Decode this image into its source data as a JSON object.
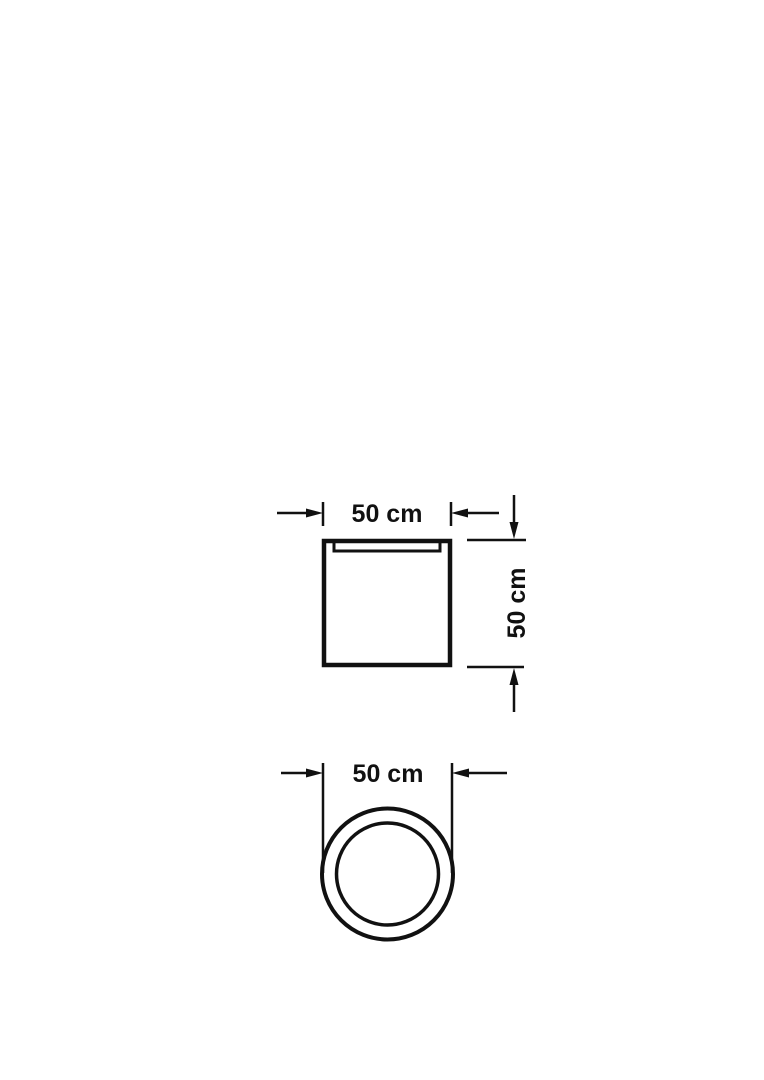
{
  "colors": {
    "line": "#111111",
    "background": "#ffffff"
  },
  "drawing": {
    "front_view": {
      "width_dimension": {
        "label": "50 cm"
      },
      "height_dimension": {
        "label": "50 cm"
      }
    },
    "top_view": {
      "diameter_dimension": {
        "label": "50 cm"
      }
    }
  }
}
